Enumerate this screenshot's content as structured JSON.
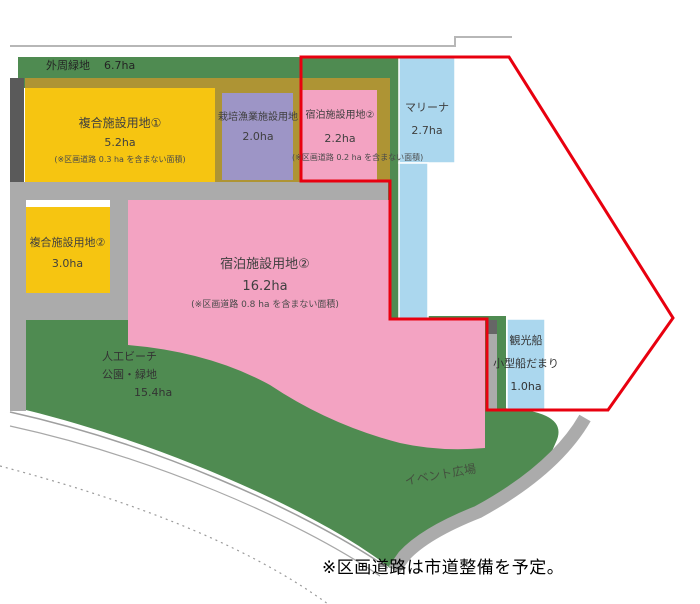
{
  "map": {
    "outer_green": {
      "label": "外周緑地",
      "area": "6.7ha"
    },
    "parcels": {
      "complex1": {
        "label": "複合施設用地①",
        "area": "5.2ha",
        "note": "(※区画道路 0.3 ha を含まない面積)"
      },
      "fishery": {
        "label": "栽培漁業施設用地",
        "area": "2.0ha"
      },
      "lodging_small": {
        "label": "宿泊施設用地②",
        "area": "2.2ha",
        "note": "(※区画道路 0.2 ha を含まない面積)"
      },
      "marina": {
        "label": "マリーナ",
        "area": "2.7ha"
      },
      "complex2": {
        "label": "複合施設用地②",
        "area": "3.0ha"
      },
      "lodging_large": {
        "label": "宿泊施設用地②",
        "area": "16.2ha",
        "note": "(※区画道路 0.8 ha を含まない面積)"
      },
      "beach_park": {
        "label1": "人工ビーチ",
        "label2": "公園・緑地",
        "area": "15.4ha"
      },
      "boat_basin": {
        "label1": "観光船",
        "label2": "小型船だまり",
        "area": "1.0ha"
      },
      "event_plaza": {
        "label": "イベント広場"
      }
    },
    "footnote": "※区画道路は市道整備を予定。",
    "colors": {
      "green": "#4f8b51",
      "olive": "#ae9434",
      "yellow": "#f6c511",
      "purple": "#9d95c6",
      "pink": "#f3a3c2",
      "blue": "#abd7ee",
      "road_light": "#ababab",
      "road_dark": "#5a5a5a",
      "boundary_red": "#e8000f"
    }
  }
}
